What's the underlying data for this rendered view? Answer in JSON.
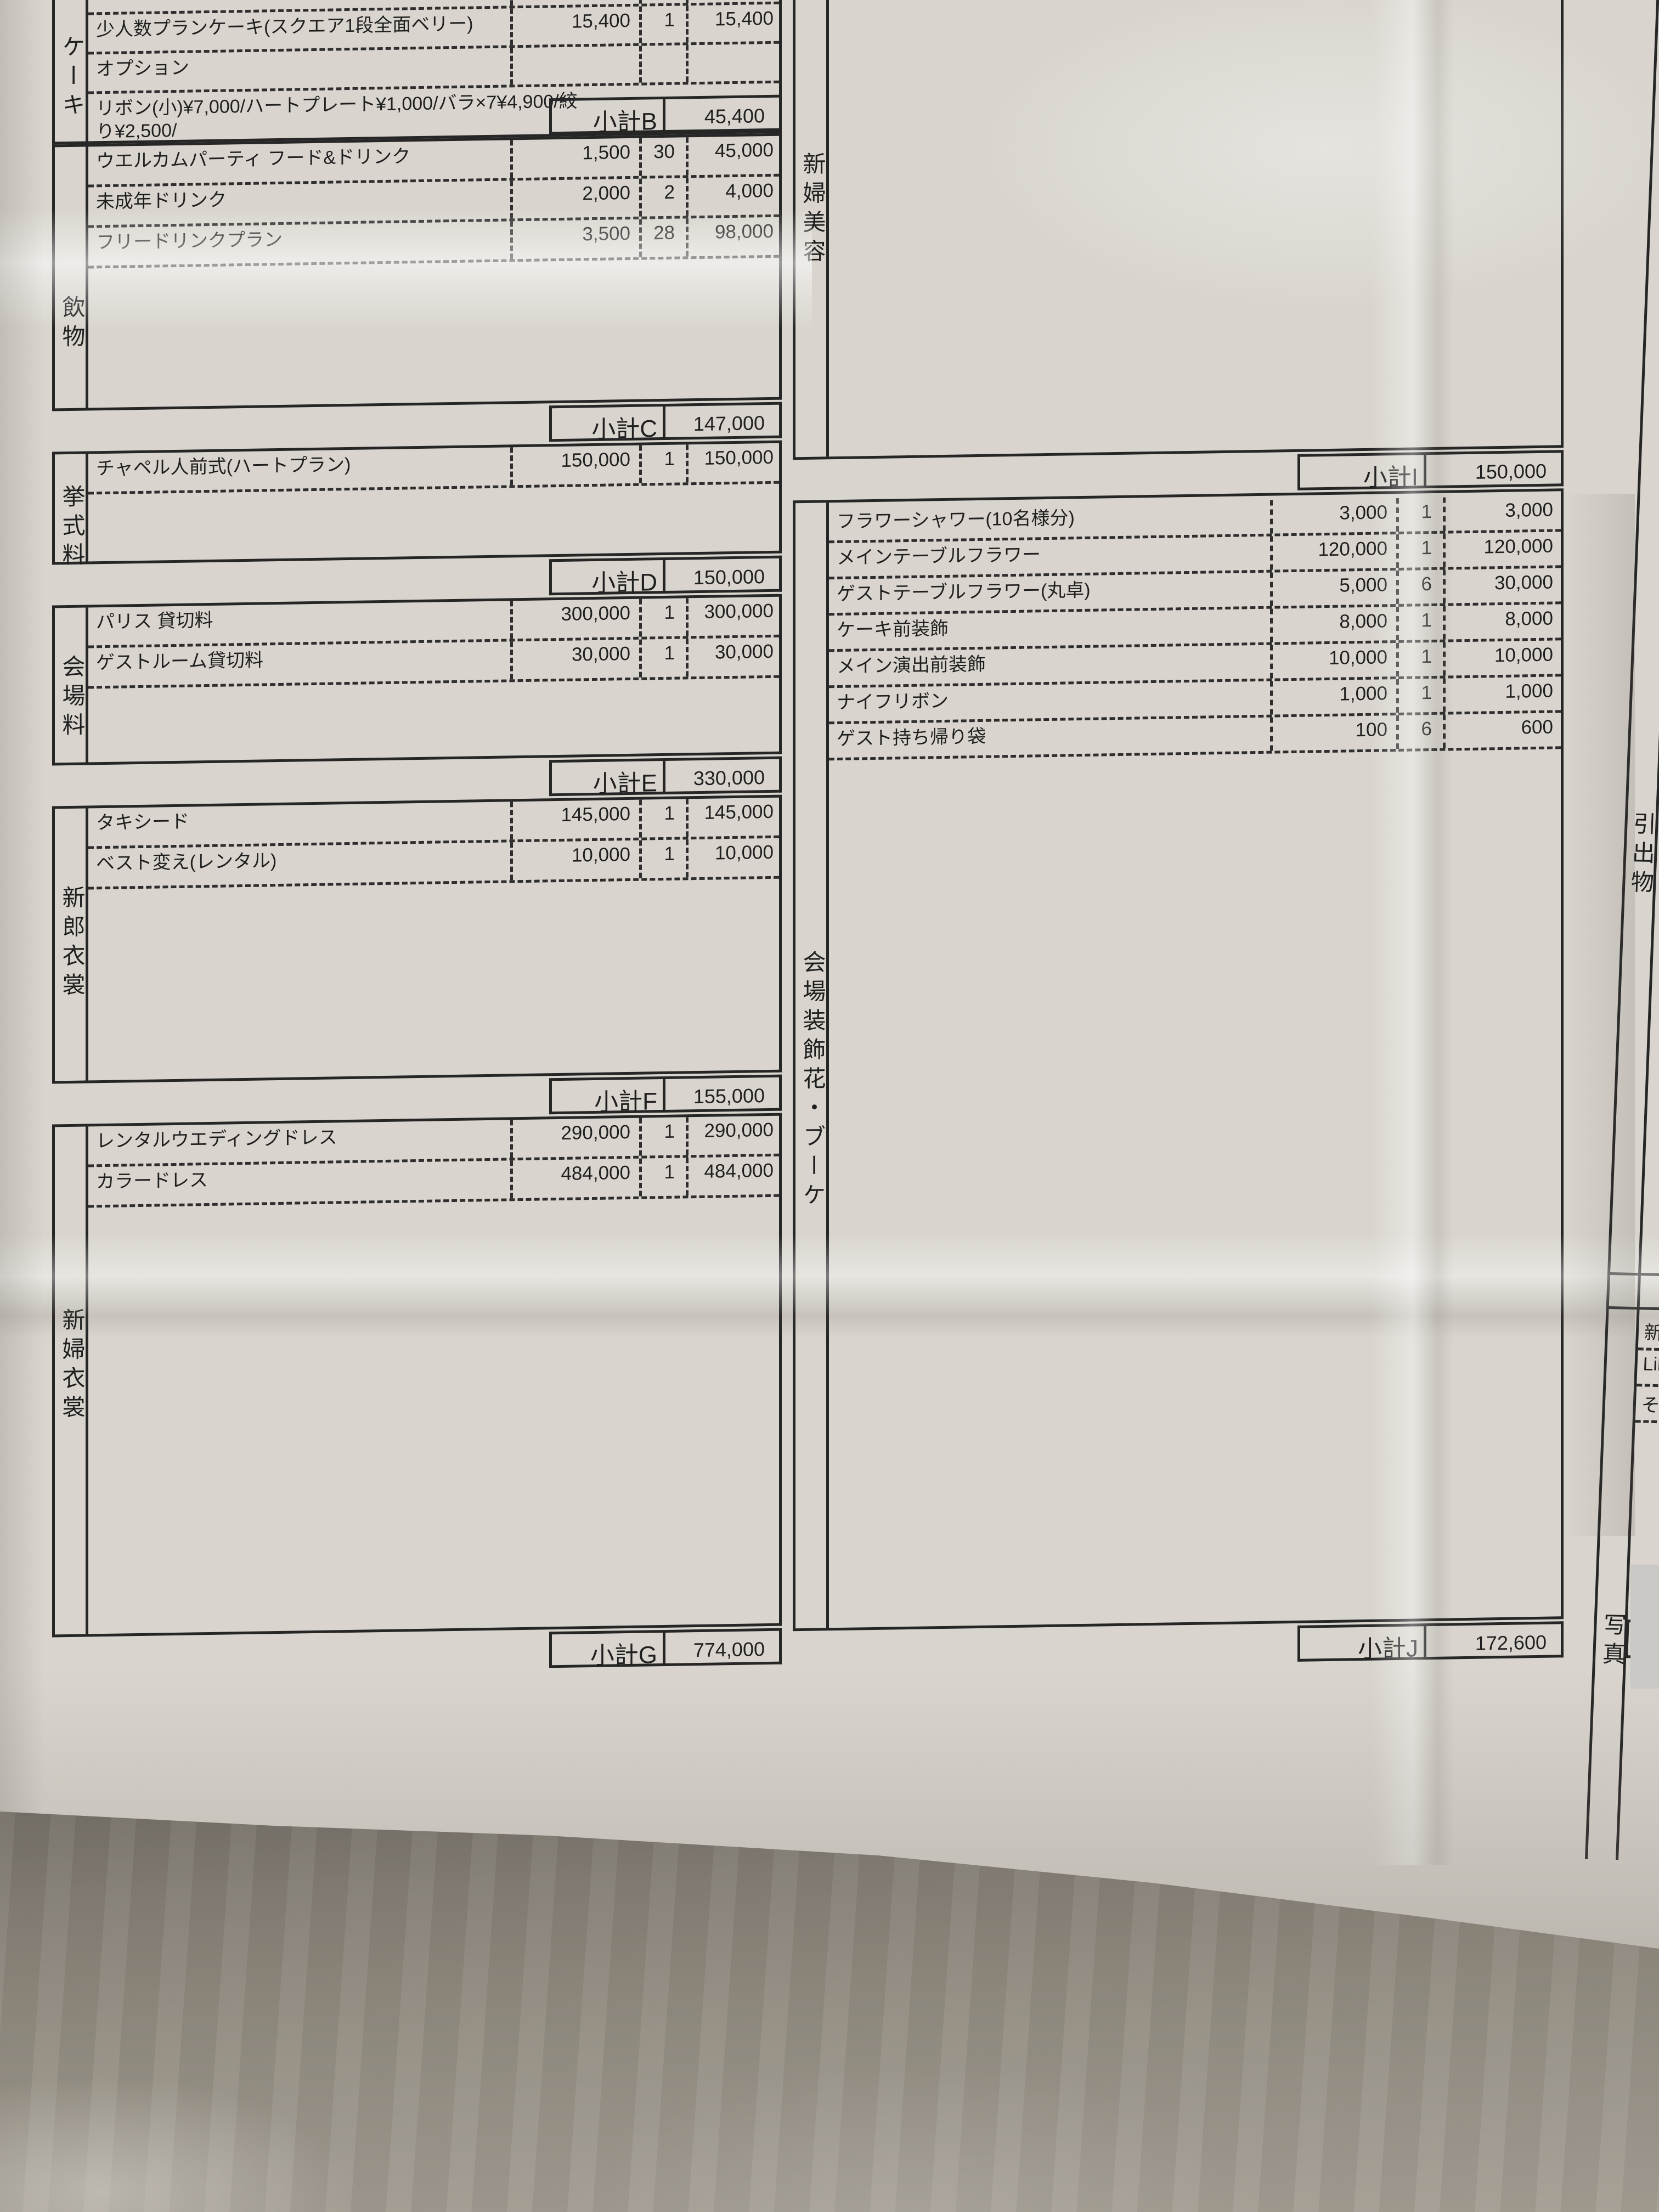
{
  "document_type": "wedding-cost-estimate-sheet",
  "colors": {
    "paper": "#d9d5ce",
    "line": "#262626",
    "floor": "#8b857b",
    "patch": "#c9c8c4"
  },
  "left_table": {
    "sections": [
      {
        "label": "ケーキ",
        "rows": [
          {
            "name": "",
            "price": "30,000",
            "qty": "",
            "amount": ""
          },
          {
            "name": "少人数プランケーキ(スクエア1段全面ベリー)",
            "price": "15,400",
            "qty": "1",
            "amount": "15,400"
          },
          {
            "name": "オプション",
            "price": "",
            "qty": "",
            "amount": ""
          },
          {
            "name": "リボン(小)¥7,000/ハートプレート¥1,000/バラ×7¥4,900/絞り¥2,500/",
            "price": "",
            "qty": "",
            "amount": ""
          }
        ],
        "subtotal": {
          "label": "小計B",
          "amount": "45,400"
        }
      },
      {
        "label": "飲物",
        "rows": [
          {
            "name": "ウエルカムパーティ フード&ドリンク",
            "price": "1,500",
            "qty": "30",
            "amount": "45,000"
          },
          {
            "name": "未成年ドリンク",
            "price": "2,000",
            "qty": "2",
            "amount": "4,000"
          },
          {
            "name": "フリードリンクプラン",
            "price": "3,500",
            "qty": "28",
            "amount": "98,000"
          }
        ],
        "subtotal": {
          "label": "小計C",
          "amount": "147,000"
        }
      },
      {
        "label": "挙式料",
        "rows": [
          {
            "name": "チャペル人前式(ハートプラン)",
            "price": "150,000",
            "qty": "1",
            "amount": "150,000"
          }
        ],
        "subtotal": {
          "label": "小計D",
          "amount": "150,000"
        }
      },
      {
        "label": "会場料",
        "rows": [
          {
            "name": "パリス 貸切料",
            "price": "300,000",
            "qty": "1",
            "amount": "300,000"
          },
          {
            "name": "ゲストルーム貸切料",
            "price": "30,000",
            "qty": "1",
            "amount": "30,000"
          }
        ],
        "subtotal": {
          "label": "小計E",
          "amount": "330,000"
        }
      },
      {
        "label": "新郎衣裳",
        "rows": [
          {
            "name": "タキシード",
            "price": "145,000",
            "qty": "1",
            "amount": "145,000"
          },
          {
            "name": "ベスト変え(レンタル)",
            "price": "10,000",
            "qty": "1",
            "amount": "10,000"
          }
        ],
        "subtotal": {
          "label": "小計F",
          "amount": "155,000"
        }
      },
      {
        "label": "新婦衣裳",
        "rows": [
          {
            "name": "レンタルウエディングドレス",
            "price": "290,000",
            "qty": "1",
            "amount": "290,000"
          },
          {
            "name": "カラードレス",
            "price": "484,000",
            "qty": "1",
            "amount": "484,000"
          }
        ],
        "subtotal": {
          "label": "小計G",
          "amount": "774,000"
        }
      }
    ]
  },
  "right_table": {
    "sections": [
      {
        "label": "新婦美容",
        "rows": [],
        "subtotal": {
          "label": "小計I",
          "amount": "150,000"
        }
      },
      {
        "label": "会場装飾花・ブーケ",
        "rows": [
          {
            "name": "フラワーシャワー(10名様分)",
            "price": "3,000",
            "qty": "1",
            "amount": "3,000"
          },
          {
            "name": "メインテーブルフラワー",
            "price": "120,000",
            "qty": "1",
            "amount": "120,000"
          },
          {
            "name": "ゲストテーブルフラワー(丸卓)",
            "price": "5,000",
            "qty": "6",
            "amount": "30,000"
          },
          {
            "name": "ケーキ前装飾",
            "price": "8,000",
            "qty": "1",
            "amount": "8,000"
          },
          {
            "name": "メイン演出前装飾",
            "price": "10,000",
            "qty": "1",
            "amount": "10,000"
          },
          {
            "name": "ナイフリボン",
            "price": "1,000",
            "qty": "1",
            "amount": "1,000"
          },
          {
            "name": "ゲスト持ち帰り袋",
            "price": "100",
            "qty": "6",
            "amount": "600"
          }
        ],
        "subtotal": {
          "label": "小計J",
          "amount": "172,600"
        }
      }
    ]
  },
  "edge_column": {
    "top_label": "引出物",
    "bottom_label": "写真",
    "rows": [
      {
        "name": "新フ"
      },
      {
        "name": "Libre"
      },
      {
        "name": "その"
      }
    ]
  }
}
